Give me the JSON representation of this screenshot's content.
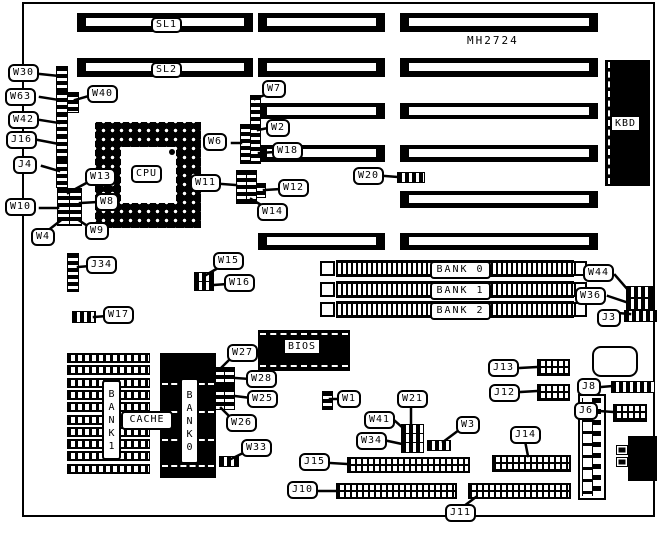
{
  "board": {
    "model": "MH2724"
  },
  "chips": {
    "cpu": "CPU",
    "bios": "BIOS",
    "kbd": "KBD",
    "cache": "CACHE",
    "bank1_vertical": "BANK1",
    "bank0_vertical": "BANK0"
  },
  "slots": {
    "rows": [
      {
        "y": 13,
        "h": 19,
        "pieces": [
          [
            77,
            253
          ],
          [
            258,
            385
          ],
          [
            400,
            598
          ]
        ],
        "label": "SL1",
        "label_x": 151
      },
      {
        "y": 58,
        "h": 19,
        "pieces": [
          [
            77,
            253
          ],
          [
            258,
            385
          ],
          [
            400,
            598
          ]
        ],
        "label": "SL2",
        "label_x": 151
      },
      {
        "y": 103,
        "h": 16,
        "pieces": [
          [
            258,
            385
          ],
          [
            400,
            598
          ]
        ]
      },
      {
        "y": 145,
        "h": 17,
        "pieces": [
          [
            258,
            385
          ],
          [
            400,
            598
          ]
        ]
      },
      {
        "y": 191,
        "h": 17,
        "pieces": [
          [
            400,
            598
          ]
        ]
      },
      {
        "y": 233,
        "h": 17,
        "pieces": [
          [
            258,
            385
          ],
          [
            400,
            598
          ]
        ]
      }
    ]
  },
  "simm_banks": [
    {
      "label": "BANK 0",
      "y": 260
    },
    {
      "label": "BANK 1",
      "y": 281
    },
    {
      "label": "BANK 2",
      "y": 301
    }
  ],
  "callouts": [
    {
      "id": "W30",
      "label": "W30",
      "x": 8,
      "y": 64,
      "line": [
        40,
        74,
        59,
        76
      ]
    },
    {
      "id": "W63",
      "label": "W63",
      "x": 5,
      "y": 88,
      "line": [
        40,
        97,
        59,
        100
      ]
    },
    {
      "id": "W40",
      "label": "W40",
      "x": 87,
      "y": 85,
      "line": [
        92,
        95,
        75,
        100
      ]
    },
    {
      "id": "W42",
      "label": "W42",
      "x": 8,
      "y": 111,
      "line": [
        40,
        120,
        59,
        123
      ]
    },
    {
      "id": "J16",
      "label": "J16",
      "x": 6,
      "y": 131,
      "line": [
        38,
        140,
        59,
        144
      ]
    },
    {
      "id": "J4",
      "label": "J4",
      "x": 13,
      "y": 156,
      "line": [
        42,
        166,
        59,
        171
      ]
    },
    {
      "id": "W13",
      "label": "W13",
      "x": 85,
      "y": 168,
      "line": [
        90,
        181,
        68,
        193
      ]
    },
    {
      "id": "W8",
      "label": "W8",
      "x": 95,
      "y": 193,
      "line": [
        98,
        202,
        80,
        203
      ]
    },
    {
      "id": "W10",
      "label": "W10",
      "x": 5,
      "y": 198,
      "line": [
        40,
        208,
        58,
        208
      ]
    },
    {
      "id": "W9",
      "label": "W9",
      "x": 85,
      "y": 222,
      "line": [
        89,
        227,
        77,
        219
      ]
    },
    {
      "id": "W4",
      "label": "W4",
      "x": 31,
      "y": 228,
      "line": [
        46,
        232,
        60,
        221
      ]
    },
    {
      "id": "J34",
      "label": "J34",
      "x": 86,
      "y": 256,
      "line": [
        90,
        266,
        78,
        267
      ]
    },
    {
      "id": "W17",
      "label": "W17",
      "x": 103,
      "y": 306,
      "line": [
        107,
        316,
        94,
        317
      ]
    },
    {
      "id": "W6",
      "label": "W6",
      "x": 203,
      "y": 133,
      "line": [
        232,
        143,
        241,
        143
      ]
    },
    {
      "id": "W7",
      "label": "W7",
      "x": 262,
      "y": 80,
      "line": [
        267,
        94,
        255,
        99
      ]
    },
    {
      "id": "W2",
      "label": "W2",
      "x": 266,
      "y": 119,
      "line": [
        268,
        128,
        258,
        130
      ]
    },
    {
      "id": "W18",
      "label": "W18",
      "x": 272,
      "y": 142,
      "line": [
        275,
        152,
        259,
        153
      ]
    },
    {
      "id": "W11",
      "label": "W11",
      "x": 190,
      "y": 174,
      "line": [
        222,
        184,
        236,
        185
      ]
    },
    {
      "id": "W12",
      "label": "W12",
      "x": 278,
      "y": 179,
      "line": [
        281,
        189,
        264,
        190
      ]
    },
    {
      "id": "W14",
      "label": "W14",
      "x": 257,
      "y": 203,
      "line": [
        263,
        206,
        251,
        199
      ]
    },
    {
      "id": "W20",
      "label": "W20",
      "x": 353,
      "y": 167,
      "line": [
        385,
        176,
        398,
        177
      ]
    },
    {
      "id": "W15",
      "label": "W15",
      "x": 213,
      "y": 252,
      "line": [
        218,
        268,
        206,
        275
      ]
    },
    {
      "id": "W16",
      "label": "W16",
      "x": 224,
      "y": 274,
      "line": [
        228,
        284,
        213,
        285
      ]
    },
    {
      "id": "W44",
      "label": "W44",
      "x": 583,
      "y": 264,
      "line": [
        615,
        275,
        628,
        290
      ]
    },
    {
      "id": "W36",
      "label": "W36",
      "x": 575,
      "y": 287,
      "line": [
        608,
        296,
        626,
        302
      ]
    },
    {
      "id": "J3",
      "label": "J3",
      "x": 597,
      "y": 309,
      "line": [
        618,
        313,
        630,
        314
      ]
    },
    {
      "id": "W27",
      "label": "W27",
      "x": 227,
      "y": 344,
      "line": [
        231,
        358,
        220,
        369
      ]
    },
    {
      "id": "W28",
      "label": "W28",
      "x": 246,
      "y": 370,
      "line": [
        250,
        379,
        235,
        378
      ]
    },
    {
      "id": "W25",
      "label": "W25",
      "x": 247,
      "y": 390,
      "line": [
        251,
        398,
        235,
        396
      ]
    },
    {
      "id": "W26",
      "label": "W26",
      "x": 226,
      "y": 414,
      "line": [
        231,
        418,
        221,
        408
      ]
    },
    {
      "id": "W33",
      "label": "W33",
      "x": 241,
      "y": 439,
      "line": [
        245,
        452,
        231,
        459
      ]
    },
    {
      "id": "W1",
      "label": "W1",
      "x": 337,
      "y": 390,
      "line": [
        340,
        399,
        330,
        399
      ]
    },
    {
      "id": "W21",
      "label": "W21",
      "x": 397,
      "y": 390,
      "line": [
        411,
        406,
        411,
        426
      ]
    },
    {
      "id": "W41",
      "label": "W41",
      "x": 364,
      "y": 411,
      "line": [
        394,
        420,
        403,
        428
      ]
    },
    {
      "id": "W34",
      "label": "W34",
      "x": 356,
      "y": 432,
      "line": [
        388,
        441,
        402,
        444
      ]
    },
    {
      "id": "W3",
      "label": "W3",
      "x": 456,
      "y": 416,
      "line": [
        459,
        430,
        443,
        442
      ]
    },
    {
      "id": "J13",
      "label": "J13",
      "x": 488,
      "y": 359,
      "line": [
        519,
        368,
        538,
        367
      ]
    },
    {
      "id": "J12",
      "label": "J12",
      "x": 489,
      "y": 384,
      "line": [
        520,
        392,
        538,
        391
      ]
    },
    {
      "id": "J8",
      "label": "J8",
      "x": 577,
      "y": 378,
      "line": [
        601,
        387,
        613,
        386
      ]
    },
    {
      "id": "J6",
      "label": "J6",
      "x": 574,
      "y": 402,
      "line": [
        599,
        411,
        614,
        412
      ]
    },
    {
      "id": "J14",
      "label": "J14",
      "x": 510,
      "y": 426,
      "line": [
        525,
        441,
        528,
        456
      ]
    },
    {
      "id": "J15",
      "label": "J15",
      "x": 299,
      "y": 453,
      "line": [
        330,
        463,
        348,
        464
      ]
    },
    {
      "id": "J10",
      "label": "J10",
      "x": 287,
      "y": 481,
      "line": [
        318,
        491,
        337,
        491
      ]
    },
    {
      "id": "J11",
      "label": "J11",
      "x": 445,
      "y": 504,
      "line": [
        464,
        506,
        476,
        497
      ]
    }
  ],
  "jumpers": [
    {
      "x": 56,
      "y": 66,
      "w": 10,
      "h": 23,
      "o": "v"
    },
    {
      "x": 56,
      "y": 90,
      "w": 10,
      "h": 21,
      "o": "v"
    },
    {
      "x": 67,
      "y": 92,
      "w": 10,
      "h": 19,
      "o": "v"
    },
    {
      "x": 56,
      "y": 112,
      "w": 10,
      "h": 22,
      "o": "v"
    },
    {
      "x": 56,
      "y": 134,
      "w": 10,
      "h": 25,
      "o": "v"
    },
    {
      "x": 56,
      "y": 159,
      "w": 10,
      "h": 27,
      "o": "v"
    },
    {
      "x": 57,
      "y": 188,
      "w": 11,
      "h": 36,
      "o": "v"
    },
    {
      "x": 69,
      "y": 188,
      "w": 11,
      "h": 36,
      "o": "v"
    },
    {
      "x": 67,
      "y": 253,
      "w": 10,
      "h": 37,
      "o": "v"
    },
    {
      "x": 72,
      "y": 311,
      "w": 22,
      "h": 10,
      "o": "h"
    },
    {
      "x": 194,
      "y": 272,
      "w": 18,
      "h": 8,
      "o": "h"
    },
    {
      "x": 194,
      "y": 281,
      "w": 18,
      "h": 8,
      "o": "h"
    },
    {
      "x": 240,
      "y": 124,
      "w": 9,
      "h": 38,
      "o": "v"
    },
    {
      "x": 250,
      "y": 95,
      "w": 9,
      "h": 29,
      "o": "v"
    },
    {
      "x": 250,
      "y": 125,
      "w": 9,
      "h": 37,
      "o": "v"
    },
    {
      "x": 236,
      "y": 170,
      "w": 9,
      "h": 32,
      "o": "v"
    },
    {
      "x": 246,
      "y": 170,
      "w": 9,
      "h": 32,
      "o": "v"
    },
    {
      "x": 256,
      "y": 183,
      "w": 8,
      "h": 13,
      "o": "v"
    },
    {
      "x": 397,
      "y": 172,
      "w": 26,
      "h": 9,
      "o": "h"
    },
    {
      "x": 626,
      "y": 286,
      "w": 25,
      "h": 10,
      "o": "h"
    },
    {
      "x": 626,
      "y": 298,
      "w": 25,
      "h": 10,
      "o": "h"
    },
    {
      "x": 624,
      "y": 310,
      "w": 31,
      "h": 10,
      "o": "h"
    },
    {
      "x": 215,
      "y": 367,
      "w": 9,
      "h": 18,
      "o": "v"
    },
    {
      "x": 224,
      "y": 367,
      "w": 9,
      "h": 18,
      "o": "v"
    },
    {
      "x": 215,
      "y": 387,
      "w": 9,
      "h": 21,
      "o": "v"
    },
    {
      "x": 224,
      "y": 387,
      "w": 9,
      "h": 21,
      "o": "v"
    },
    {
      "x": 219,
      "y": 456,
      "w": 18,
      "h": 9,
      "o": "h"
    },
    {
      "x": 322,
      "y": 391,
      "w": 9,
      "h": 17,
      "o": "v"
    },
    {
      "x": 401,
      "y": 424,
      "w": 21,
      "h": 9,
      "o": "h"
    },
    {
      "x": 401,
      "y": 433,
      "w": 21,
      "h": 9,
      "o": "h"
    },
    {
      "x": 401,
      "y": 442,
      "w": 21,
      "h": 9,
      "o": "h"
    },
    {
      "x": 427,
      "y": 440,
      "w": 22,
      "h": 9,
      "o": "h"
    },
    {
      "x": 611,
      "y": 381,
      "w": 42,
      "h": 10,
      "o": "h"
    }
  ],
  "headers": [
    {
      "id": "J13",
      "x": 537,
      "y": 359,
      "w": 33,
      "h": 17
    },
    {
      "id": "J12",
      "x": 537,
      "y": 384,
      "w": 33,
      "h": 17
    },
    {
      "id": "J6",
      "x": 613,
      "y": 404,
      "w": 34,
      "h": 18
    },
    {
      "id": "J14",
      "x": 492,
      "y": 455,
      "w": 79,
      "h": 17
    },
    {
      "id": "J15",
      "x": 347,
      "y": 457,
      "w": 123,
      "h": 16
    },
    {
      "id": "J10",
      "x": 336,
      "y": 483,
      "w": 121,
      "h": 16
    },
    {
      "id": "J11",
      "x": 468,
      "y": 483,
      "w": 103,
      "h": 16
    }
  ],
  "colors": {
    "ink": "#000000",
    "paper": "#ffffff"
  }
}
